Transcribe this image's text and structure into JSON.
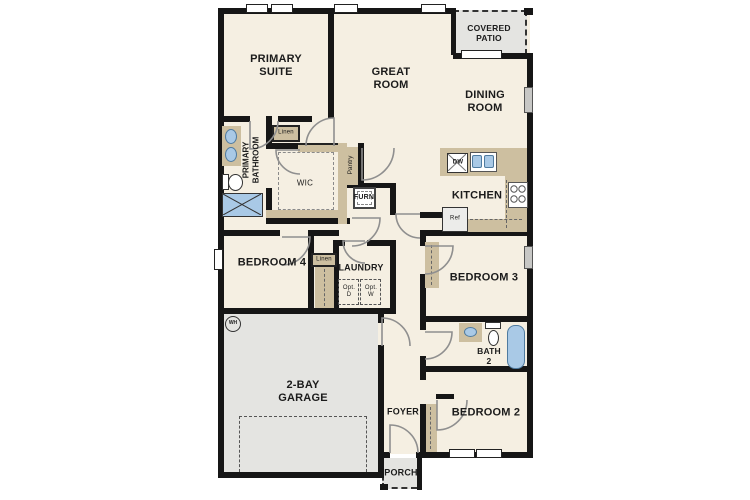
{
  "plan": {
    "title": "single-story floor plan",
    "rooms": {
      "primary_suite": "PRIMARY\nSUITE",
      "great_room": "GREAT\nROOM",
      "covered_patio": "COVERED\nPATIO",
      "dining_room": "DINING\nROOM",
      "kitchen": "KITCHEN",
      "primary_bathroom": "PRIMARY\nBATHROOM",
      "wic": "WIC",
      "pantry": "Pantry",
      "furn": "FURN",
      "linen_upper": "Linen",
      "linen_hall": "Linen",
      "bedroom_4": "BEDROOM 4",
      "laundry": "LAUNDRY",
      "bedroom_3": "BEDROOM 3",
      "garage": "2-BAY\nGARAGE",
      "bath_2": "BATH\n2",
      "foyer": "FOYER",
      "bedroom_2": "BEDROOM 2",
      "porch": "PORCH"
    },
    "appliances": {
      "dishwasher": "DW",
      "refrigerator": "Ref",
      "water_heater": "WH",
      "opt_dryer": "Opt.\nD",
      "opt_washer": "Opt.\nW"
    },
    "colors": {
      "wall": "#161616",
      "floor": "#f5efe2",
      "concrete": "#e4e4e1",
      "casework": "#cdbfa0",
      "fixture": "#a9c9e6"
    }
  }
}
